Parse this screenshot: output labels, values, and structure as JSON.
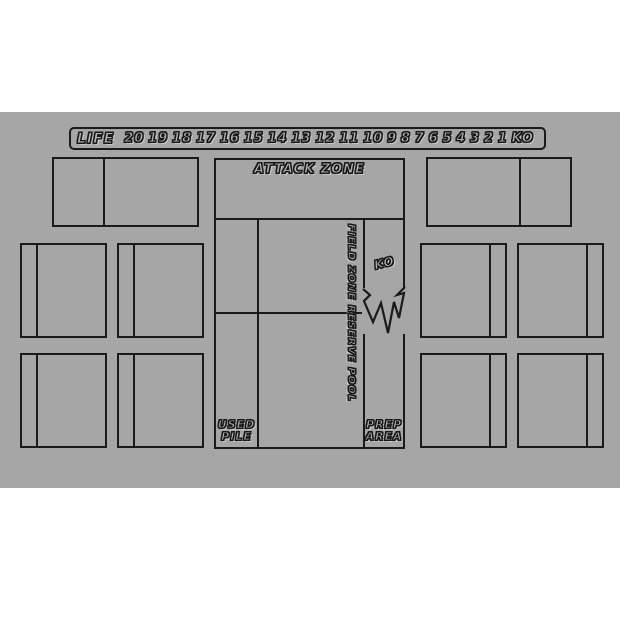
{
  "colors": {
    "page_bg": "#ffffff",
    "mat_bg": "#a6a6a6",
    "line": "#1a1a1a",
    "bubble_fill": "#b3b3b3"
  },
  "life_track": {
    "label": "LIFE",
    "values": [
      "20",
      "19",
      "18",
      "17",
      "16",
      "15",
      "14",
      "13",
      "12",
      "11",
      "10",
      "9",
      "8",
      "7",
      "6",
      "5",
      "4",
      "3",
      "2",
      "1",
      "KO"
    ]
  },
  "zones": {
    "attack": "ATTACK ZONE",
    "field": "FIELD ZONE",
    "reserve": "RESERVE POOL",
    "ko": "KO",
    "used_line1": "USED",
    "used_line2": "PILE",
    "prep_line1": "PREP",
    "prep_line2": "AREA"
  }
}
